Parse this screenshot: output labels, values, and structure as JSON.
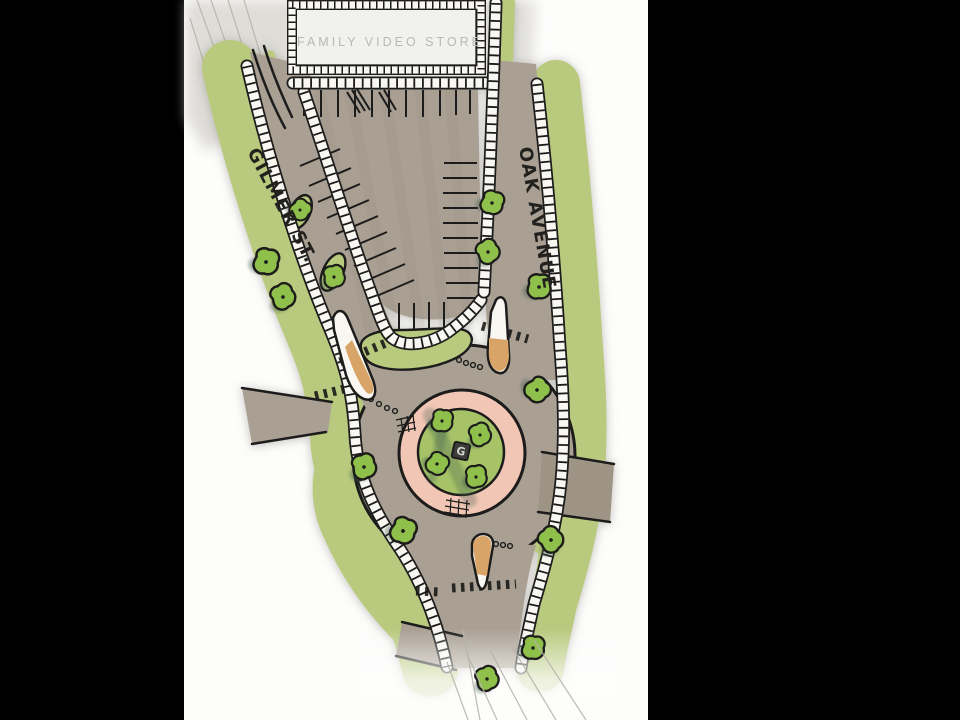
{
  "labels": {
    "building": "FAMILY VIDEO STORE",
    "street_left": "GILMER ST.",
    "street_right": "OAK AVENUE",
    "roundabout_center_marker": "G"
  },
  "scene": {
    "type": "hand-drawn roundabout site plan sketch on presentation slide",
    "central_island_tree_count": 4,
    "splitter_island_count": 3
  },
  "colors": {
    "slide_bar": "#000000",
    "paper": "#fdfdfc",
    "wash": "#cfccc6",
    "asphalt": "#a9a093",
    "asphalt_dark": "#9e9486",
    "lawn": "#b9c97d",
    "tree": "#8fc04c",
    "tree_shadow": "#45604f",
    "island_green": "#a6c368",
    "apron_pink": "#f2c6b5",
    "island_tan": "#d8a468",
    "sidewalk": "#f8f7f2",
    "ink": "#1d1c1a",
    "building_fill": "#f1f1ef",
    "building_text": "#b9b8b4",
    "pencil": "#b6b3aa"
  }
}
